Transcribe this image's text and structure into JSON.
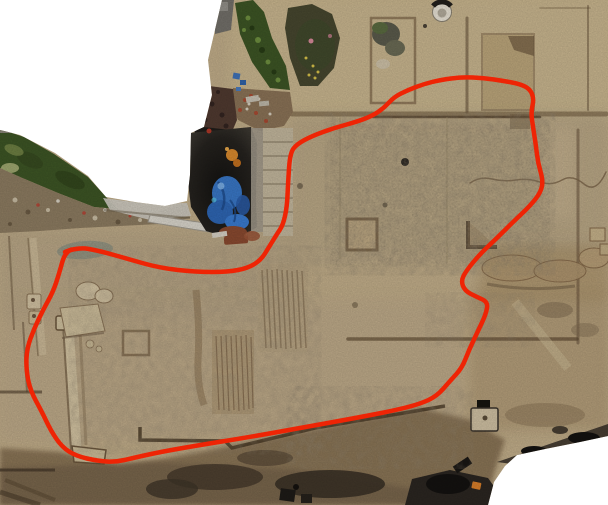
{
  "scene": {
    "type": "aerial-orthophoto",
    "description": "Drone orthophoto of an archaeological excavation site seen from above; a hand-drawn irregular red outline marks the excavated building complex. The photomosaic has irregular white cut-out edges (top-left notch and bottom-right wedge).",
    "background_color": "#ffffff",
    "width": 608,
    "height": 505
  },
  "annotation": {
    "label": "excavation-area-outline",
    "color": "#ee2405",
    "stroke_width": 4.5,
    "points": [
      [
        65,
        252
      ],
      [
        78,
        247
      ],
      [
        100,
        251
      ],
      [
        128,
        259
      ],
      [
        160,
        268
      ],
      [
        196,
        272
      ],
      [
        228,
        272
      ],
      [
        248,
        268
      ],
      [
        261,
        260
      ],
      [
        269,
        247
      ],
      [
        277,
        234
      ],
      [
        283,
        225
      ],
      [
        287,
        207
      ],
      [
        288,
        184
      ],
      [
        290,
        153
      ],
      [
        297,
        144
      ],
      [
        312,
        136
      ],
      [
        334,
        128
      ],
      [
        356,
        122
      ],
      [
        372,
        116
      ],
      [
        384,
        108
      ],
      [
        394,
        97
      ],
      [
        408,
        90
      ],
      [
        424,
        84
      ],
      [
        440,
        80
      ],
      [
        462,
        77
      ],
      [
        484,
        78
      ],
      [
        504,
        81
      ],
      [
        520,
        84
      ],
      [
        530,
        89
      ],
      [
        534,
        99
      ],
      [
        531,
        112
      ],
      [
        533,
        127
      ],
      [
        536,
        146
      ],
      [
        538,
        163
      ],
      [
        543,
        180
      ],
      [
        541,
        192
      ],
      [
        530,
        206
      ],
      [
        514,
        221
      ],
      [
        497,
        238
      ],
      [
        480,
        254
      ],
      [
        466,
        271
      ],
      [
        461,
        281
      ],
      [
        465,
        291
      ],
      [
        477,
        297
      ],
      [
        488,
        302
      ],
      [
        486,
        314
      ],
      [
        478,
        331
      ],
      [
        469,
        350
      ],
      [
        462,
        368
      ],
      [
        450,
        381
      ],
      [
        437,
        396
      ],
      [
        420,
        404
      ],
      [
        392,
        411
      ],
      [
        350,
        419
      ],
      [
        300,
        428
      ],
      [
        250,
        437
      ],
      [
        200,
        445
      ],
      [
        160,
        452
      ],
      [
        133,
        458
      ],
      [
        116,
        462
      ],
      [
        98,
        461
      ],
      [
        76,
        456
      ],
      [
        62,
        447
      ],
      [
        51,
        431
      ],
      [
        42,
        412
      ],
      [
        30,
        390
      ],
      [
        26,
        368
      ],
      [
        27,
        348
      ],
      [
        34,
        329
      ],
      [
        43,
        310
      ],
      [
        53,
        292
      ],
      [
        59,
        274
      ]
    ]
  },
  "palette": {
    "terrain_base": "#c2ae8a",
    "terrain_light": "#cbb890",
    "terrain_speckled": "#b4a383",
    "trench_line": "#66513a",
    "bottom_earth": "#8a7456",
    "pit_dark": "#23211d",
    "tarp_blue": "#3977c6",
    "tarp_blue_dark": "#1d4a8a",
    "vegetation_green": "#3d5525",
    "vegetation_light": "#6f9040",
    "rubble_grey": "#8d7c61",
    "walkway_grey": "#cfcac0",
    "stone_light": "#d2c2a2",
    "orange_item": "#d98a2e",
    "terracotta_item": "#8a4a30",
    "shadow_black": "#141210"
  },
  "features": [
    {
      "name": "red-outline-annotation",
      "desc": "irregular closed red line around central and lower excavation trenches"
    },
    {
      "name": "equipment-pit",
      "desc": "dark shaded pit with blue tarpaulins, terracotta finds and an orange bucket, upper-centre"
    },
    {
      "name": "vegetated-slope",
      "desc": "green overgrown slope band on upper-left edge"
    },
    {
      "name": "trench-grid",
      "desc": "rectangular excavation trench lines and sondage squares in tan soil"
    },
    {
      "name": "survey-wellhead",
      "desc": "small white circular feature at top centre"
    },
    {
      "name": "stone-blocks",
      "desc": "scattered ashlar blocks and boulders, left-centre"
    },
    {
      "name": "dark-trench-strip",
      "desc": "deep brown/black excavated strip along the bottom"
    },
    {
      "name": "white-voids",
      "desc": "white no-data regions of the orthomosaic at top-left and bottom-right"
    }
  ]
}
